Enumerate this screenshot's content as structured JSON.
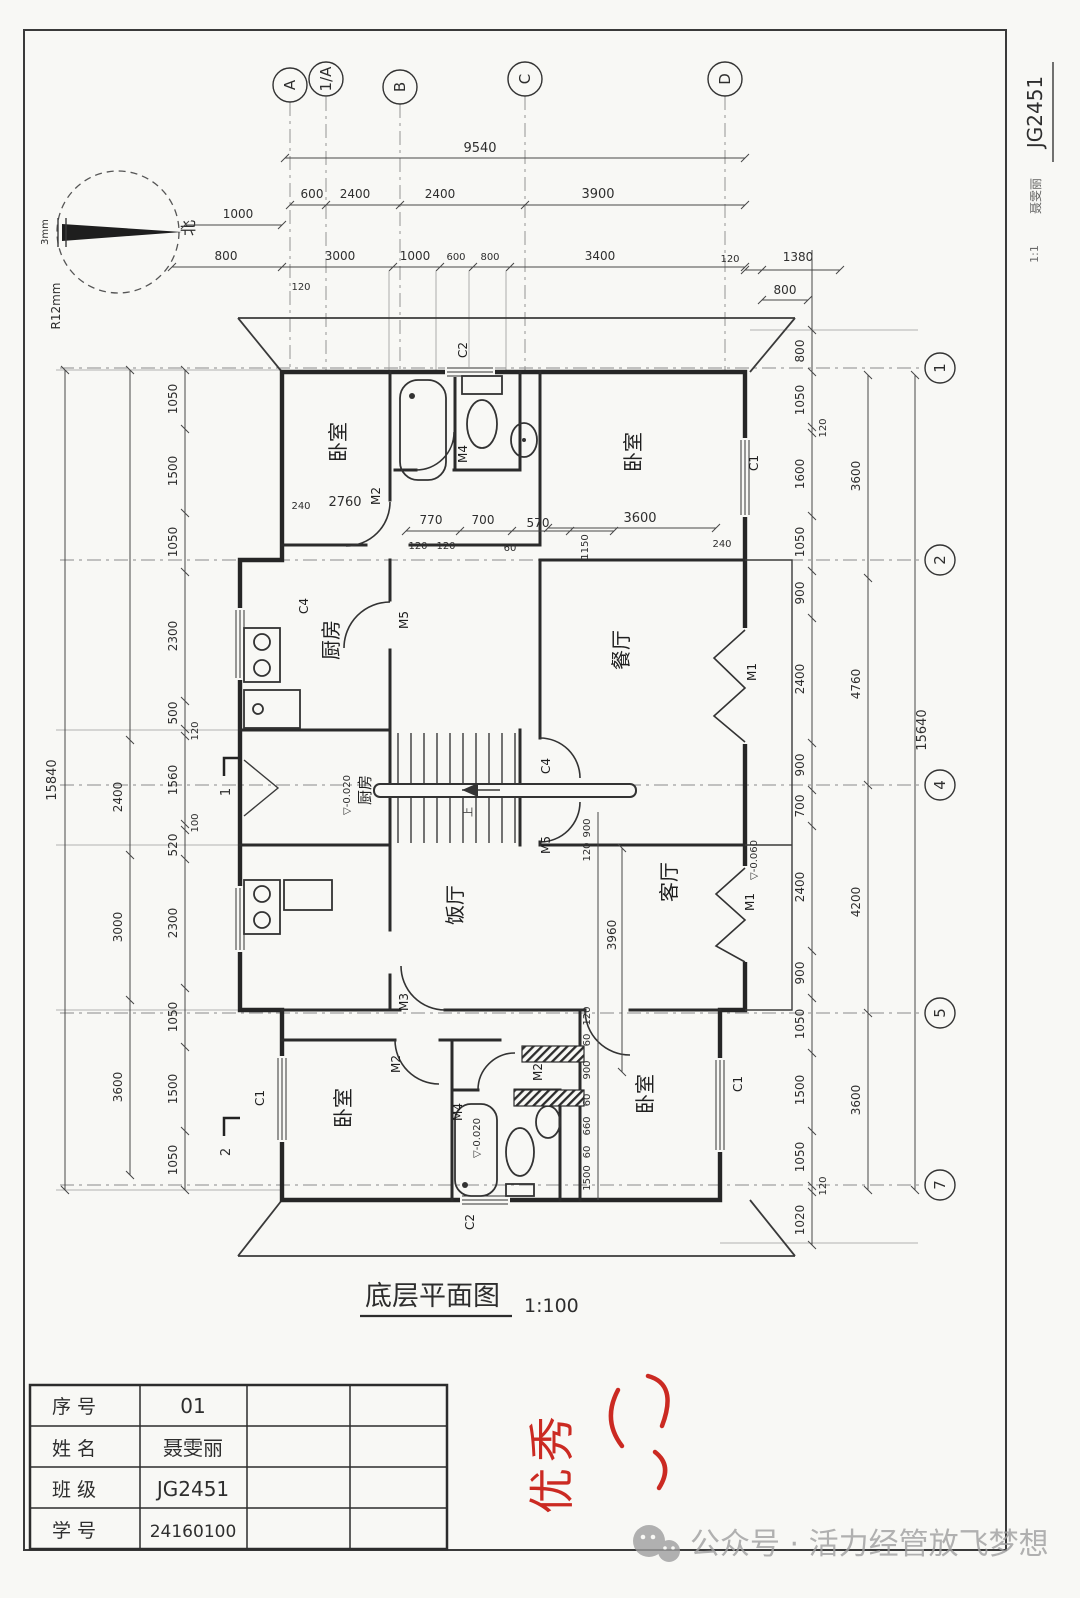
{
  "sheet": {
    "plan_title": "底层平面图",
    "plan_scale": "1:100"
  },
  "compass": {
    "north": "北",
    "radius": "R12mm",
    "width": "3mm"
  },
  "axis_top": {
    "a": "A",
    "a1": "1/A",
    "b": "B",
    "c": "C",
    "d": "D"
  },
  "axis_right": {
    "n1": "1",
    "n2": "2",
    "n4": "4",
    "n5": "5",
    "n7": "7"
  },
  "dims_top": {
    "total": "9540",
    "row2": [
      "600",
      "2400",
      "2400",
      "3900"
    ],
    "left_1000": "1000",
    "row3": [
      "800",
      "3000",
      "1000",
      "600",
      "800",
      "3400"
    ],
    "sub_120": "120",
    "right_120": "120",
    "right_1380": "1380",
    "right_800": "800"
  },
  "dims_left": {
    "outer": "15840",
    "middle": [
      "2400",
      "3000",
      "3600"
    ],
    "inner": [
      "1050",
      "1500",
      "1050",
      "2300",
      "500",
      "120",
      "1560",
      "100",
      "520",
      "2300",
      "1050",
      "1500",
      "1050"
    ],
    "section_1": "1",
    "section_2": "2"
  },
  "dims_right": {
    "outer": "15640",
    "middle": [
      "3600",
      "4760",
      "4200",
      "3600"
    ],
    "inner": [
      "800",
      "1050",
      "120",
      "1600",
      "1050",
      "900",
      "2400",
      "900",
      "700",
      "2400",
      "900",
      "1050",
      "1500",
      "1050",
      "120",
      "1020"
    ]
  },
  "inner_dims": {
    "tl": [
      "240",
      "2760"
    ],
    "bath_top": [
      "770",
      "700",
      "570"
    ],
    "bath_sub": [
      "120",
      "120",
      "60",
      "1150"
    ],
    "tr": [
      "3600",
      "240"
    ],
    "center": [
      "3960",
      "120",
      "60",
      "900",
      "60",
      "660",
      "60",
      "1500"
    ],
    "entry": [
      "900",
      "120"
    ]
  },
  "rooms": {
    "bedroom_tl": "卧室",
    "bedroom_tr": "卧室",
    "kitchen_top": "厨房",
    "kitchen_mid": "厨房",
    "dining": "餐厅",
    "hall": "饭厅",
    "living": "客厅",
    "bedroom_bl": "卧室",
    "bedroom_br": "卧室",
    "stair_up": "上"
  },
  "openings": {
    "c1_tr": "C1",
    "c1_bl": "C1",
    "c1_br": "C1",
    "c2_top": "C2",
    "c2_bottom": "C2",
    "c4_kitchen": "C4",
    "c4_entry": "C4",
    "m1_dining": "M1",
    "m1_living": "M1",
    "m2_tl": "M2",
    "m2_bl": "M2",
    "m2_bc": "M2",
    "m3_bl": "M3",
    "m4_top": "M4",
    "m4_bottom": "M4",
    "m5_kitchen": "M5",
    "m5_entry": "M5"
  },
  "elevations": {
    "kitchen": "▽-0.020",
    "living": "▽-0.060",
    "bath": "▽-0.020"
  },
  "title_block": {
    "rows": [
      {
        "label": "序 号",
        "value": "01"
      },
      {
        "label": "姓 名",
        "value": "聂雯丽"
      },
      {
        "label": "班 级",
        "value": "JG2451"
      },
      {
        "label": "学 号",
        "value": "24160100"
      }
    ]
  },
  "grade": {
    "mark": "优秀"
  },
  "watermark": {
    "text": "公众号 · 活力经管放飞梦想"
  },
  "side_note": {
    "line1": "JG2451",
    "line2": "聂雯丽",
    "line3": "1:1"
  }
}
